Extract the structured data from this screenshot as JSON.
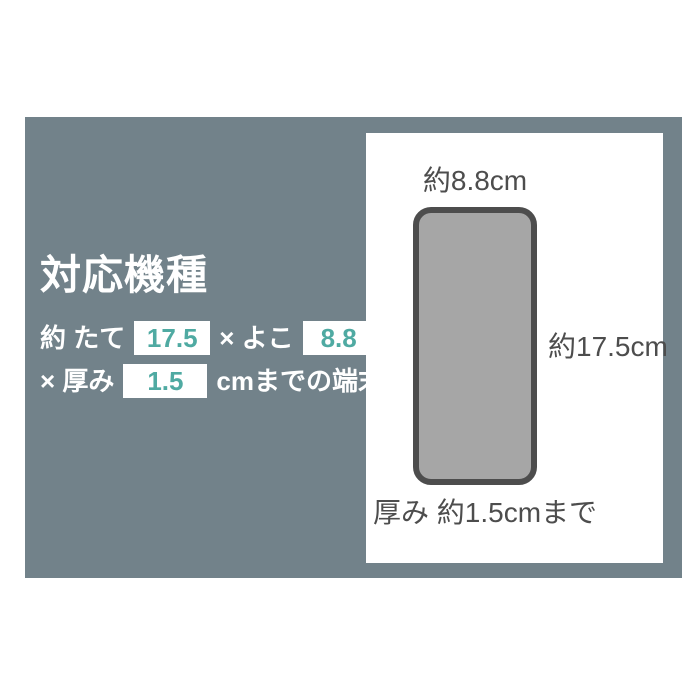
{
  "colors": {
    "board_gray": "#72828A",
    "accent_teal": "#4FAAA2",
    "phone_fill": "#A6A6A6",
    "phone_border": "#4D4D4D",
    "dark_text": "#4D4D4D",
    "white": "#FFFFFF"
  },
  "spec": {
    "title": "対応機種",
    "line1": {
      "prefix": "約 たて",
      "height_value": "17.5",
      "middle": "× よこ",
      "width_value": "8.8"
    },
    "line2": {
      "prefix": "× 厚み",
      "thickness_value": "1.5",
      "suffix": "cmまでの端末"
    }
  },
  "diagram": {
    "width_label": "約8.8cm",
    "height_label": "約17.5cm",
    "thickness_label": "厚み 約1.5cmまで"
  }
}
